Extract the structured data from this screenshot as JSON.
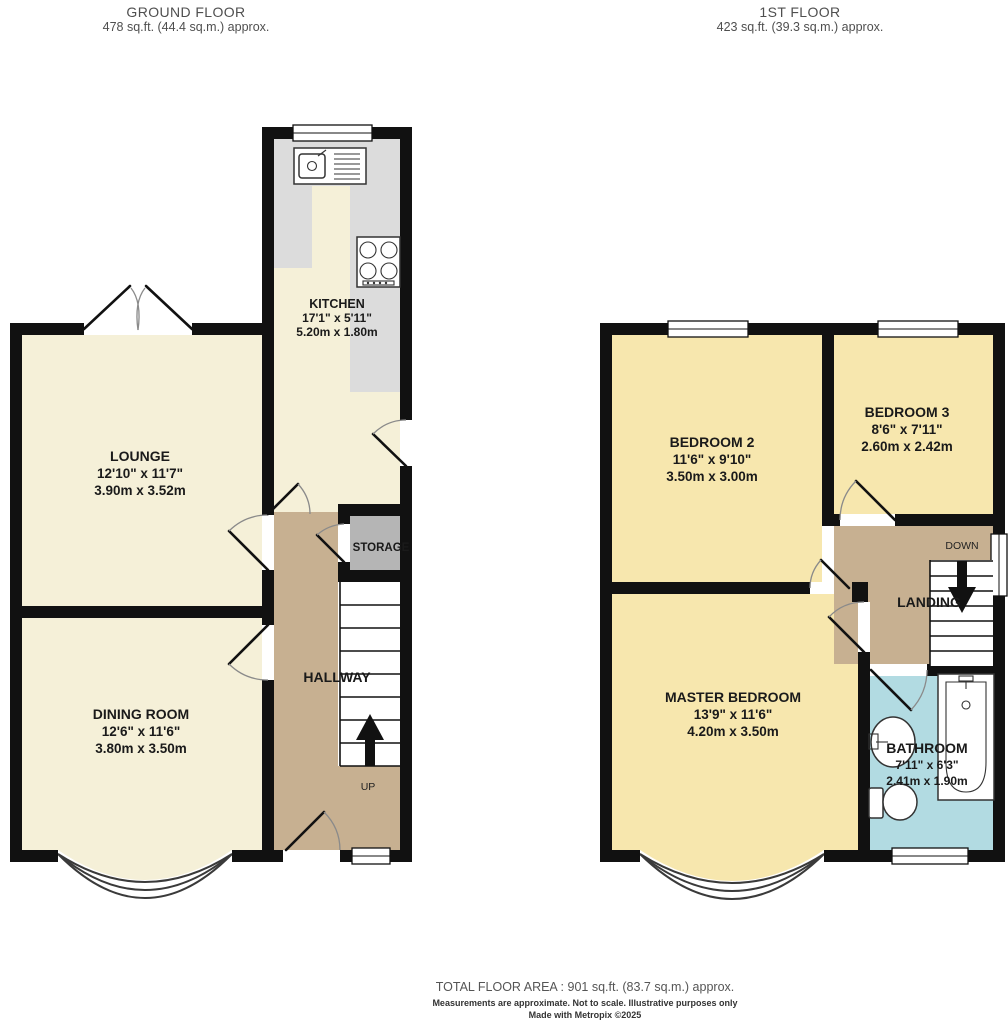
{
  "ground_floor": {
    "title": "GROUND FLOOR",
    "area": "478 sq.ft. (44.4 sq.m.) approx.",
    "rooms": {
      "kitchen": {
        "name": "KITCHEN",
        "imperial": "17'1\"  x 5'11\"",
        "metric": "5.20m  x 1.80m"
      },
      "lounge": {
        "name": "LOUNGE",
        "imperial": "12'10\"  x 11'7\"",
        "metric": "3.90m  x 3.52m"
      },
      "dining_room": {
        "name": "DINING ROOM",
        "imperial": "12'6\"  x 11'6\"",
        "metric": "3.80m  x 3.50m"
      },
      "hallway": {
        "name": "HALLWAY"
      },
      "storage": {
        "name": "STORAGE"
      },
      "stair_direction": "UP"
    }
  },
  "first_floor": {
    "title": "1ST FLOOR",
    "area": "423 sq.ft. (39.3 sq.m.) approx.",
    "rooms": {
      "bedroom_2": {
        "name": "BEDROOM 2",
        "imperial": "11'6\"  x 9'10\"",
        "metric": "3.50m  x 3.00m"
      },
      "bedroom_3": {
        "name": "BEDROOM 3",
        "imperial": "8'6\"  x 7'11\"",
        "metric": "2.60m  x 2.42m"
      },
      "master_bedroom": {
        "name": "MASTER BEDROOM",
        "imperial": "13'9\"  x 11'6\"",
        "metric": "4.20m  x 3.50m"
      },
      "bathroom": {
        "name": "BATHROOM",
        "imperial": "7'11\"  x 6'3\"",
        "metric": "2.41m  x 1.90m"
      },
      "landing": {
        "name": "LANDING"
      },
      "stair_direction": "DOWN"
    }
  },
  "footer": {
    "total_area": "TOTAL FLOOR AREA : 901 sq.ft. (83.7 sq.m.) approx.",
    "disclaimer": "Measurements are approximate.  Not to scale.  Illustrative purposes only",
    "credit": "Made with Metropix ©2025"
  },
  "colors": {
    "wall": "#111111",
    "cream": "#f5f0d8",
    "gold": "#f7e7ae",
    "tan": "#c7b091",
    "storage": "#b5b5b5",
    "counter": "#dcdcdc",
    "bath": "#b2dbe2"
  }
}
